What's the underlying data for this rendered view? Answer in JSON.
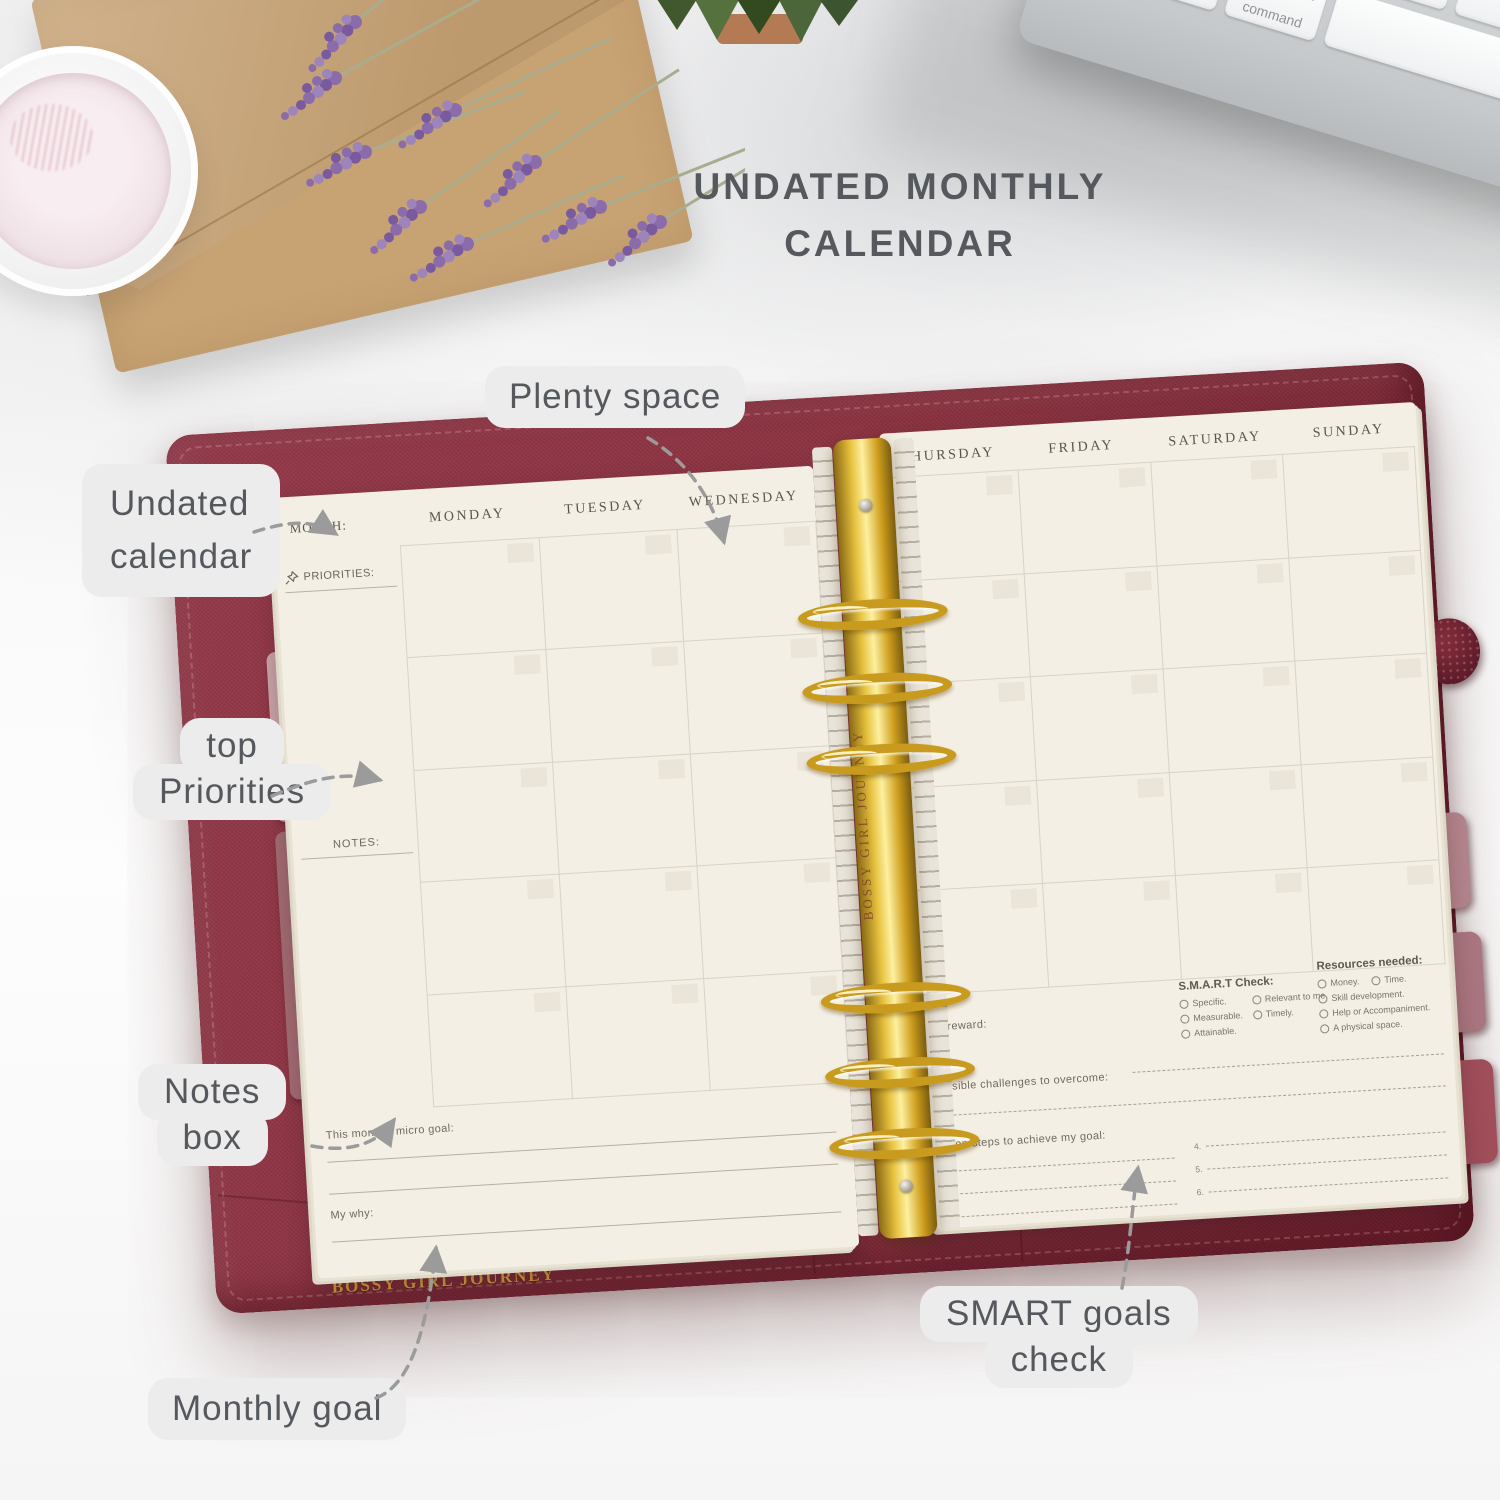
{
  "title": {
    "line1": "UNDATED MONTHLY",
    "line2": "CALENDAR"
  },
  "annotations": {
    "plenty_space": "Plenty space",
    "undated_line1": "Undated",
    "undated_line2": "calendar",
    "priorities_line1": "top",
    "priorities_line2": "Priorities",
    "notes_line1": "Notes",
    "notes_line2": "box",
    "monthly_goal": "Monthly goal",
    "smart_line1": "SMART goals",
    "smart_line2": "check"
  },
  "planner": {
    "brand": "BOSSY GIRL JOURNEY",
    "left_page": {
      "month_label": "MONTH:",
      "priorities_label": "PRIORITIES:",
      "notes_label": "NOTES:",
      "day_headers": [
        "MONDAY",
        "TUESDAY",
        "WEDNESDAY"
      ],
      "micro_goal_label": "This month's micro goal:",
      "my_why_label": "My why:"
    },
    "right_page": {
      "day_headers": [
        "THURSDAY",
        "FRIDAY",
        "SATURDAY",
        "SUNDAY"
      ],
      "my_reward_label": "My reward:",
      "smart_heading": "S.M.A.R.T Check:",
      "smart_col1": [
        "Specific.",
        "Measurable.",
        "Attainable."
      ],
      "smart_col2": [
        "Relevant to me.",
        "Timely."
      ],
      "resources_heading": "Resources needed:",
      "resources_row1a": "Money.",
      "resources_row1b": "Time.",
      "resources_rest": [
        "Skill development.",
        "Help or Accompaniment.",
        "A physical space."
      ],
      "challenges_label": "Possible challenges to overcome:",
      "action_label": "Action steps to achieve my goal:",
      "action_left": [
        "1.",
        "2.",
        "3."
      ],
      "action_right": [
        "4.",
        "5.",
        "6."
      ]
    }
  },
  "keyboard": {
    "letters": [
      "V",
      "B",
      "N",
      "M"
    ],
    "control": "control",
    "option": "option",
    "command": "command",
    "command_symbol": "⌘"
  },
  "colors": {
    "binder_burgundy": "#8b3240",
    "gold": "#d1a02a",
    "page_cream": "#f4efe4",
    "label_bg": "#ececec",
    "label_text": "#55585c",
    "tab_mauve": "#ab7680",
    "lavender": "#8b6cab",
    "envelope_kraft": "#c7a273"
  }
}
